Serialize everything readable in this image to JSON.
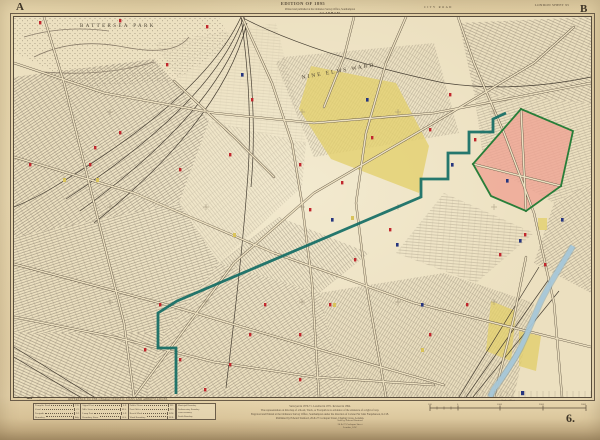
{
  "plate": {
    "edition_line": "EDITION OF 1895",
    "top_imprint_1": "Printed and published at the Ordnance Survey Office, Southampton",
    "top_imprint_2": "CLAPHAM",
    "sheet_label": "LONDON SHEET 95",
    "plate_number": "6.",
    "corners": {
      "top_left": "A",
      "top_right": "B",
      "bottom_left": "C",
      "bottom_right": "D"
    },
    "revision_note_1": "Railways corrected",
    "revision_note_2": "to December 1894."
  },
  "map_labels": {
    "park": "BATTERSEA PARK",
    "ward": "NINE ELMS WARD",
    "edge_road": "CITY ROAD"
  },
  "legend": {
    "heading": "REFERENCE TO THE CHARACTERISTIC SIGNS AND ABBREVIATIONS",
    "groups": [
      {
        "rows": [
          {
            "label": "Turnpike Road",
            "code": "T.R."
          },
          {
            "label": "Canal",
            "code": "Cl."
          },
          {
            "label": "Footpath",
            "code": "F.P."
          },
          {
            "label": "Boundary",
            "code": "Bdy."
          }
        ]
      },
      {
        "rows": [
          {
            "label": "Signal Post",
            "code": "S.P."
          },
          {
            "label": "Mile Stone",
            "code": "M.S."
          },
          {
            "label": "Lamp Post",
            "code": "L.P."
          },
          {
            "label": "Boundary Stone",
            "code": "B.S."
          }
        ]
      },
      {
        "rows": [
          {
            "label": "Public House",
            "code": "P.H."
          },
          {
            "label": "Post Office",
            "code": "P.O."
          },
          {
            "label": "Bench Mark",
            "code": "B.M."
          },
          {
            "label": "Ward Boundary",
            "code": "W.B."
          }
        ]
      }
    ],
    "side_notes": [
      "Municipal Boundary",
      "Parliamentary Boundary",
      "Ward Boundary",
      "Parish Boundary"
    ]
  },
  "imprint": {
    "lines": [
      "Surveyed in 1870-71. Levelled in 1871. Revised in 1894.",
      "The representation on this map of a Road, Track, or Footpath is no evidence of the existence of a right of way.",
      "Engraved and Printed at the Ordnance Survey Office, Southampton under the direction of Colonel Sir John Farquharson, K.C.B.",
      "Published by Edward Stanford, 26 & 27 Cockspur Street, Charing Cross, London."
    ],
    "agent_lines": [
      "Sold by Edward Stanford",
      "26 & 27 Cockspur Street",
      "London, S.W."
    ]
  },
  "scale_bar": {
    "caption": "Scale of Feet",
    "numbers": [
      "500",
      "0",
      "1000",
      "2000",
      "3000"
    ]
  },
  "colors": {
    "paper": "#e7d6ae",
    "map_paper": "#ece0c0",
    "ink": "#57493a",
    "boundary_teal": "#0e6a63",
    "area_pink": "#efa493",
    "area_pink_outline": "#1d7a33",
    "area_yellow": "#e3cf6b",
    "river_blue": "#a7c9da",
    "marker_red": "#c1272d",
    "marker_blue": "#26357e"
  }
}
